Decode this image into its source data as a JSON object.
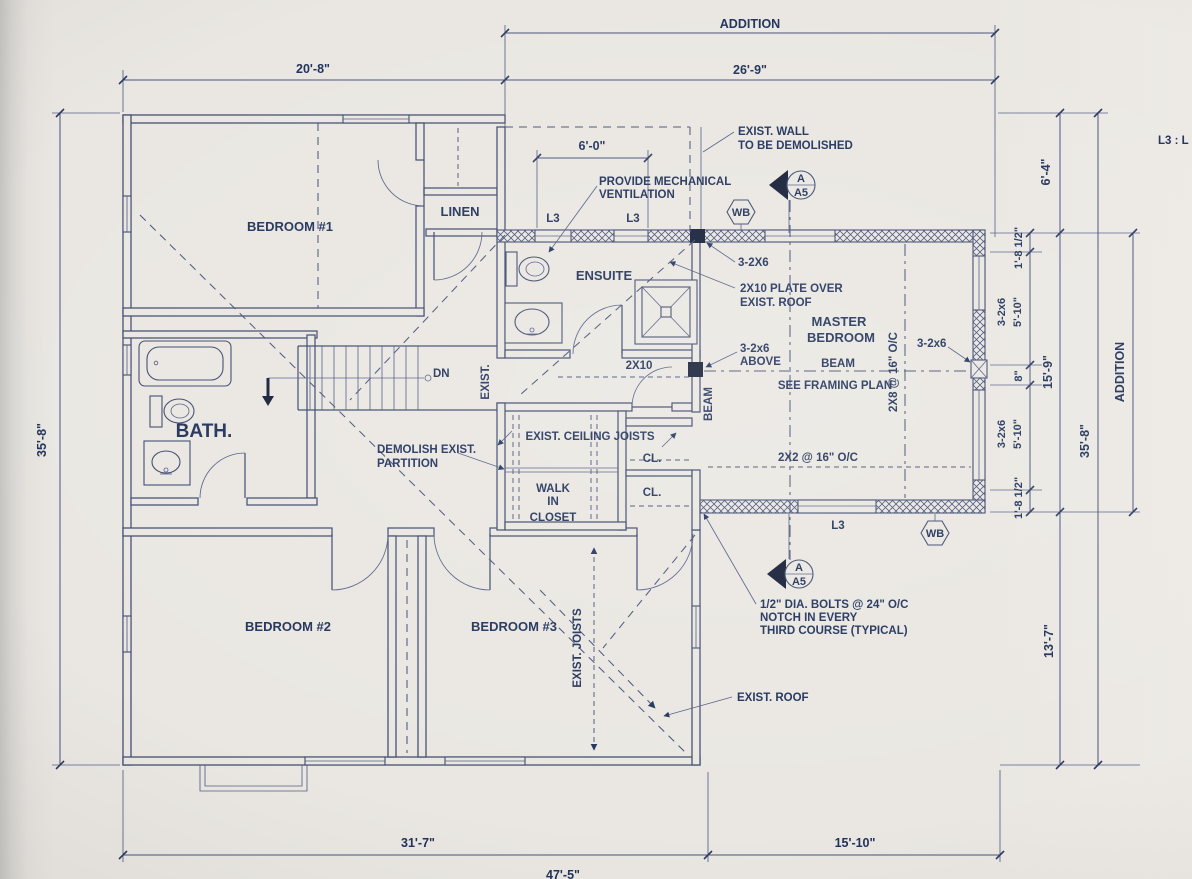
{
  "colors": {
    "ink": "#20325a",
    "line": "#46527a",
    "paper": "#eae7e2",
    "post": "#141d36"
  },
  "dims": {
    "addition_top": "ADDITION",
    "d26_9": "26'-9\"",
    "d20_8": "20'-8\"",
    "d6_0": "6'-0\"",
    "d6_4": "6'-4\"",
    "d35_8": "35'-8\"",
    "d15_9": "15'-9\"",
    "d13_7": "13'-7\"",
    "d31_7": "31'-7\"",
    "d15_10": "15'-10\"",
    "d47_5": "47'-5\"",
    "d1_8h": "1'-8 1/2\"",
    "d5_10": "5'-10\"",
    "d8": "8\"",
    "w3_2x6": "3-2x6",
    "addition_right": "ADDITION"
  },
  "rooms": {
    "bedroom1": "BEDROOM #1",
    "linen": "LINEN",
    "ensuite": "ENSUITE",
    "master1": "MASTER",
    "master2": "BEDROOM",
    "bath": "BATH.",
    "bedroom2": "BEDROOM #2",
    "bedroom3": "BEDROOM #3",
    "walk1": "WALK",
    "walk2": "IN",
    "walk3": "CLOSET",
    "cl": "CL."
  },
  "notes": {
    "exist_wall1": "EXIST. WALL",
    "exist_wall2": "TO BE DEMOLISHED",
    "vent1": "PROVIDE MECHANICAL",
    "vent2": "VENTILATION",
    "n3_2x6_top": "3-2X6",
    "plate1": "2X10 PLATE OVER",
    "plate2": "EXIST. ROOF",
    "above1": "3-2x6",
    "above2": "ABOVE",
    "beam": "BEAM",
    "see_framing": "SEE FRAMING PLAN",
    "x2x8": "2X8 @ 16\" O/C",
    "x2x2": "2X2 @ 16\" O/C",
    "n2x10": "2X10",
    "exist_v": "EXIST.",
    "beam_v": "BEAM",
    "dn": "DN",
    "demo1": "DEMOLISH EXIST.",
    "demo2": "PARTITION",
    "ceil_joists": "EXIST. CEILING JOISTS",
    "exist_joists": "EXIST. JOISTS",
    "bolts1": "1/2\" DIA. BOLTS @ 24\" O/C",
    "bolts2": "NOTCH IN EVERY",
    "bolts3": "THIRD COURSE (TYPICAL)",
    "exist_roof": "EXIST. ROOF",
    "r3_2x6": "3-2x6",
    "legend": "L3 : L"
  },
  "markers": {
    "l3": "L3",
    "wb": "WB",
    "sec_a": "A",
    "sec_a5": "A5"
  }
}
